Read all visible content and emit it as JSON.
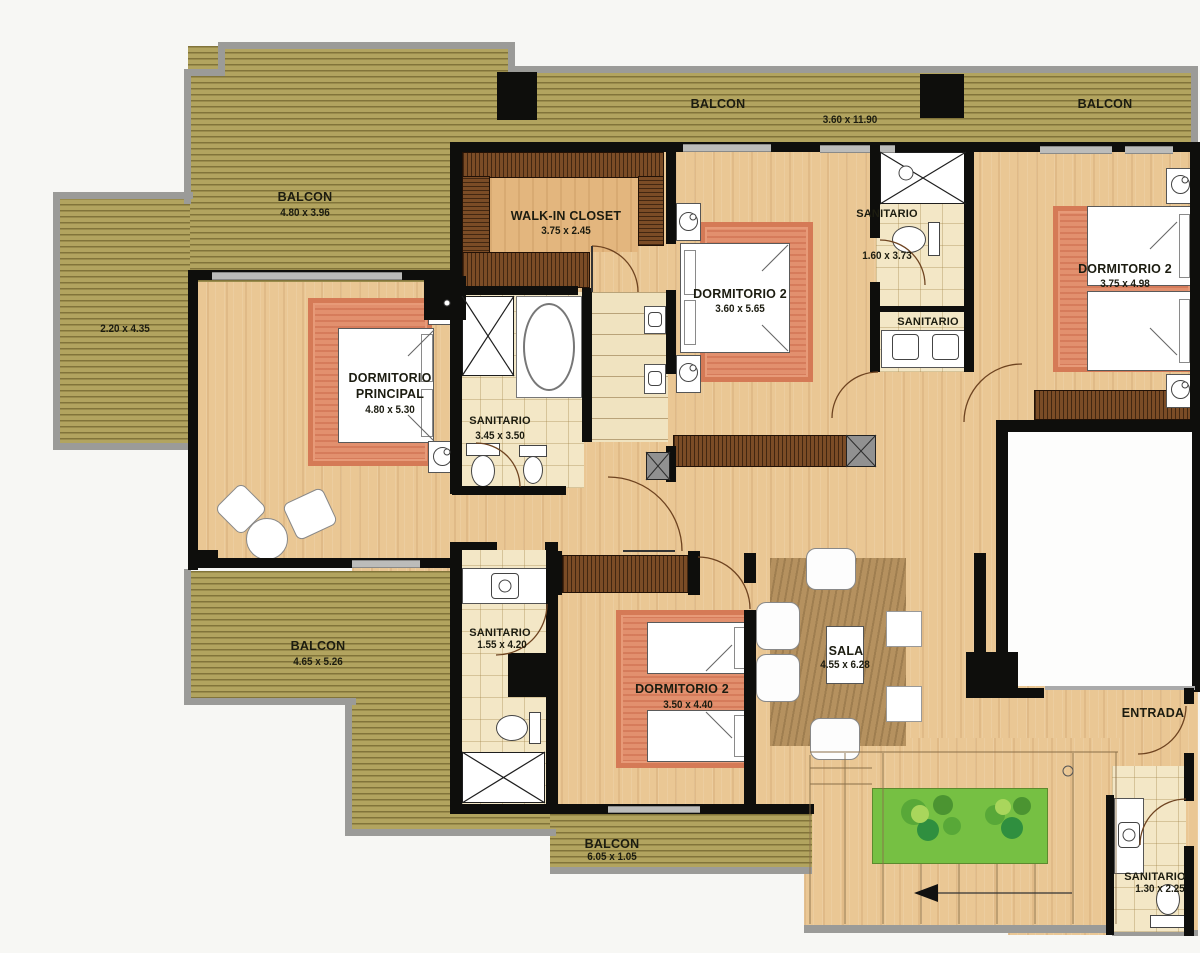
{
  "plan_title": "apartment floor plan",
  "rooms": {
    "balcony_top_left": {
      "label": "BALCON",
      "dims": "4.80 x 3.96"
    },
    "balcony_top": {
      "label": "BALCON",
      "dims": "3.60 x 11.90"
    },
    "balcony_top_right": {
      "label": "BALCON"
    },
    "balcony_left": {
      "dims": "2.20 x 4.35"
    },
    "walk_in_closet": {
      "label": "WALK-IN CLOSET",
      "dims": "3.75 x 2.45"
    },
    "dormitorio_principal": {
      "line1": "DORMITORIO",
      "line2": "PRINCIPAL",
      "dims": "4.80 x 5.30"
    },
    "sanitario_principal": {
      "label": "SANITARIO",
      "dims": "3.45 x 3.50"
    },
    "dormitorio2_top": {
      "label": "DORMITORIO 2",
      "dims": "3.60 x 5.65"
    },
    "sanitario_top": {
      "label": "SANITARIO",
      "dims": "1.60 x 3.73"
    },
    "sanitario_mid": {
      "label": "SANITARIO"
    },
    "dormitorio2_right": {
      "label": "DORMITORIO 2",
      "dims": "3.75 x 4.98"
    },
    "balcony_bottom_left": {
      "label": "BALCON",
      "dims": "4.65 x 5.26"
    },
    "sanitario_bottom": {
      "label": "SANITARIO",
      "dims": "1.55 x 4.20"
    },
    "dormitorio2_bottom": {
      "label": "DORMITORIO 2",
      "dims": "3.50 x 4.40"
    },
    "sala": {
      "label": "SALA",
      "dims": "4.55 x 6.28"
    },
    "entrada": {
      "label": "ENTRADA"
    },
    "balcony_bottom": {
      "label": "BALCON",
      "dims": "6.05 x 1.05"
    },
    "sanitario_entrada": {
      "label": "SANITARIO",
      "dims": "1.30 x 2.25"
    }
  },
  "colors": {
    "deck": "#b2a45f",
    "wood": "#eac794",
    "rug": "#e2906e",
    "tile": "#f3e7c6",
    "grass": "#76c043",
    "wall": "#0e0e0c",
    "wood_rail": "#7b4c26",
    "outline": "#9b9b98"
  }
}
